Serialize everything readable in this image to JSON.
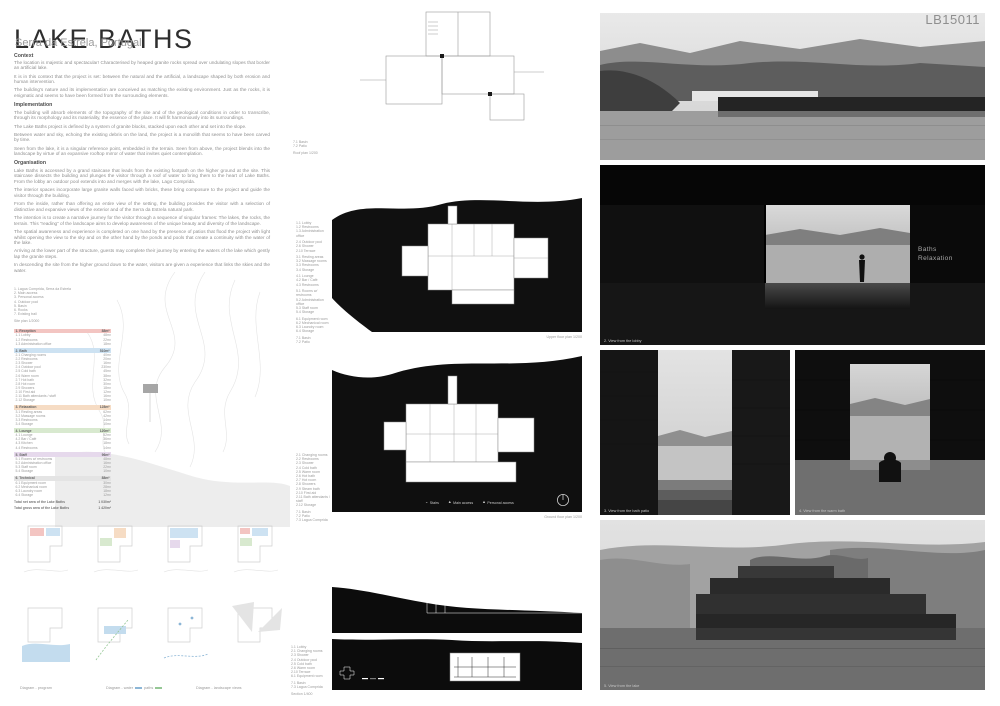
{
  "board": {
    "id": "LB15011",
    "title": "LAKE BATHS",
    "subtitle": "Serra da Estrela, Portugal"
  },
  "sections": [
    {
      "heading": "Context",
      "paragraphs": [
        "The location is majestic and spectacular! Characterised by heaped granite rocks spread over undulating slopes that border an artificial lake.",
        "It is in this context that the project is set: between the natural and the artificial, a landscape shaped by both erosion and human intervention.",
        "The building's nature and its implementation are conceived as matching the existing environment.  Just as the rocks, it is enigmatic and seems to have been formed from the surrounding elements."
      ]
    },
    {
      "heading": "Implementation",
      "paragraphs": [
        "The building will absorb elements of the topography of the site and of the geological conditions in order to transcribe, through its morphology and its materiality, the essence of the place. It will fit harmoniously into its surroundings.",
        "The Lake Baths project is defined by a system of granite blocks, stacked upon each other and set into the slope.",
        "Between water and sky, echoing the existing debris on the land, the project is a monolith that seems to have been carved by time.",
        "Seen from the lake, it is a singular reference point, embedded in the terrain. Seen from above, the project blends into the landscape by virtue of an expansive rooftop mirror of water that invites quiet contemplation."
      ]
    },
    {
      "heading": "Organisation",
      "paragraphs": [
        "Lake Baths is accessed by a grand staircase that leads from the existing footpath on the higher ground at the site. This staircase dissects the building and plunges the visitor through a roof of water to bring them to the heart of Lake Baths. From the lobby an outdoor pool extends into and merges with the lake, Lago Comprida.",
        "The interior spaces incorporate large granite walls faced with bricks, these bring composure to the project and guide the visitor through the building.",
        "From the inside, rather than offering an entire view of the setting, the building provides the visitor with a selection of distinctive and expansive views of the exterior and of the Serra da Estrela natural park.",
        "The intention is to create a narrative journey for the visitor through a sequence of singular frames: The lakes, the rocks, the terrain. This “reading” of the landscape aims to develop awareness of the unique beauty and diversity of the landscape.",
        "The spatial awareness and experience is completed on one hand by the presence of patios that flood the project with light whilst opening the view to the sky and on the other hand by the ponds and pools that create a continuity with the water of the lake.",
        "Arriving at the lower part of the structure, guests may complete their journey by entering the waters of the lake which gently lap the granite steps.",
        "In descending the site from the higher ground down to the water, visitors are given a experience that links the skies and the water."
      ]
    }
  ],
  "site_plan": {
    "legend": [
      "1. Lagoa Comprida, Serra da Estrela",
      "2. Main access",
      "3. Personal access",
      "4. Outdoor pool",
      "5. Basin",
      "6. Rocks",
      "7. Existing trail"
    ],
    "scale_label": "Site plan 1/2000"
  },
  "program": {
    "rows": [
      {
        "cls": "hdr c1",
        "label": "1. Reception",
        "area": "88m²"
      },
      {
        "cls": "item",
        "label": "1.1 Lobby",
        "area": "48m²"
      },
      {
        "cls": "item",
        "label": "1.2 Restrooms",
        "area": "22m²"
      },
      {
        "cls": "item",
        "label": "1.3 Administration office",
        "area": "18m²"
      },
      {
        "cls": "hdr c2",
        "label": "2. Bath",
        "area": "510m²"
      },
      {
        "cls": "item",
        "label": "2.1 Changing rooms",
        "area": "40m²"
      },
      {
        "cls": "item",
        "label": "2.2 Restrooms",
        "area": "20m²"
      },
      {
        "cls": "item",
        "label": "2.3 Shower",
        "area": "16m²"
      },
      {
        "cls": "item",
        "label": "2.4 Outdoor pool",
        "area": "230m²"
      },
      {
        "cls": "item",
        "label": "2.5 Cold bath",
        "area": "45m²"
      },
      {
        "cls": "item",
        "label": "2.6 Warm room",
        "area": "38m²"
      },
      {
        "cls": "item",
        "label": "2.7 Hot bath",
        "area": "32m²"
      },
      {
        "cls": "item",
        "label": "2.8 Hot room",
        "area": "30m²"
      },
      {
        "cls": "item",
        "label": "2.9 Showers",
        "area": "18m²"
      },
      {
        "cls": "item",
        "label": "2.10 First aid",
        "area": "12m²"
      },
      {
        "cls": "item",
        "label": "2.11 Bath attendants / staff",
        "area": "16m²"
      },
      {
        "cls": "item",
        "label": "2.12 Storage",
        "area": "10m²"
      },
      {
        "cls": "hdr c3",
        "label": "3. Relaxation",
        "area": "128m²"
      },
      {
        "cls": "item",
        "label": "3.1 Resting areas",
        "area": "62m²"
      },
      {
        "cls": "item",
        "label": "3.2 Massage rooms",
        "area": "42m²"
      },
      {
        "cls": "item",
        "label": "3.3 Restrooms",
        "area": "14m²"
      },
      {
        "cls": "item",
        "label": "3.4 Storage",
        "area": "10m²"
      },
      {
        "cls": "hdr c4",
        "label": "4. Lounge",
        "area": "120m²"
      },
      {
        "cls": "item",
        "label": "4.1 Lounge",
        "area": "52m²"
      },
      {
        "cls": "item",
        "label": "4.2 Bar / Café",
        "area": "36m²"
      },
      {
        "cls": "item",
        "label": "4.3 Kitchen",
        "area": "18m²"
      },
      {
        "cls": "item",
        "label": "4.4 Restrooms",
        "area": "14m²"
      },
      {
        "cls": "hdr c5",
        "label": "5. Staff",
        "area": "96m²"
      },
      {
        "cls": "item",
        "label": "5.1 Rooms w/ restrooms",
        "area": "48m²"
      },
      {
        "cls": "item",
        "label": "5.2 Administration office",
        "area": "16m²"
      },
      {
        "cls": "item",
        "label": "5.3 Staff room",
        "area": "22m²"
      },
      {
        "cls": "item",
        "label": "5.4 Storage",
        "area": "10m²"
      },
      {
        "cls": "hdr c6",
        "label": "6. Technical",
        "area": "88m²"
      },
      {
        "cls": "item",
        "label": "6.1 Equipment room",
        "area": "30m²"
      },
      {
        "cls": "item",
        "label": "6.2 Mechanical room",
        "area": "28m²"
      },
      {
        "cls": "item",
        "label": "6.3 Laundry room",
        "area": "18m²"
      },
      {
        "cls": "item",
        "label": "6.4 Storage",
        "area": "12m²"
      },
      {
        "cls": "total",
        "label": "Total net area of the Lake Baths",
        "area": "1 030m²"
      },
      {
        "cls": "total",
        "label": "Total gross area of the Lake Baths",
        "area": "1 420m²"
      }
    ]
  },
  "plans": {
    "roof": {
      "legend": [
        "7.1 Basin",
        "7.2 Patio"
      ],
      "label": "Roof plan 1/200"
    },
    "upper": {
      "legend": [
        "1.1 Lobby",
        "1.2 Restrooms",
        "1.3 Administration office",
        "",
        "2.4 Outdoor pool",
        "2.6 Shower",
        "2.10 Terrace",
        "",
        "3.1 Resting areas",
        "3.2 Massage rooms",
        "3.3 Restrooms",
        "3.4 Storage",
        "",
        "4.1 Lounge",
        "4.2 Bar / Café",
        "4.3 Restrooms",
        "",
        "5.1 Rooms w/ restrooms",
        "5.2 Administration office",
        "5.3 Staff room",
        "5.4 Storage",
        "",
        "6.1 Equipment room",
        "6.2 Mechanical room",
        "6.3 Laundry room",
        "6.4 Storage",
        "",
        "7.1 Basin",
        "7.2 Patio"
      ],
      "label": "Upper floor plan 1/200"
    },
    "ground": {
      "legend": [
        "2.1 Changing rooms",
        "2.2 Restrooms",
        "2.3 Shower",
        "2.4 Cold bath",
        "2.5 Warm room",
        "2.6 Hot bath",
        "2.7 Hot room",
        "2.8 Showers",
        "2.9 Steam bath",
        "2.10 First aid",
        "2.11 Bath attendants / staff",
        "2.12 Storage",
        "",
        "7.1 Basin",
        "7.2 Patio",
        "7.3 Lagoa Comprida"
      ],
      "label": "Ground floor plan 1/200",
      "markers": [
        {
          "glyph": "⌄",
          "label": "Stairs"
        },
        {
          "glyph": "▲",
          "label": "Main access"
        },
        {
          "glyph": "▲",
          "label": "Personal access"
        }
      ]
    },
    "section": {
      "legend": [
        "1.1 Lobby",
        "2.1 Changing rooms",
        "2.3 Shower",
        "2.4 Outdoor pool",
        "2.5 Cold bath",
        "2.6 Warm room",
        "2.10 Terrace",
        "6.1 Equipment room",
        "",
        "7.1 Basin",
        "7.3 Lagoa Comprida"
      ],
      "label": "Section 1/400"
    }
  },
  "diagrams": {
    "captions": {
      "left": "Diagram - program",
      "mid_a": "Diagram - water",
      "mid_b": "paths",
      "right": "Diagram - landscape views"
    }
  },
  "renders": {
    "r2": {
      "caption": "2. View from the lobby",
      "wall_line1": "Baths",
      "wall_line2": "Relaxation"
    },
    "r3": {
      "caption": "3. View from the bath patio"
    },
    "r4": {
      "caption": "4. View from the warm bath"
    },
    "r5": {
      "caption": "5. View from the lake"
    }
  },
  "colors": {
    "reception": "#f3c5c2",
    "bath": "#cde2f2",
    "relaxation": "#f6dcc4",
    "lounge": "#d8e9cf",
    "staff": "#e6d9ec",
    "technical": "#e4e4e4",
    "water_swatch": "#8cb6d6",
    "paths_swatch": "#95c795"
  }
}
